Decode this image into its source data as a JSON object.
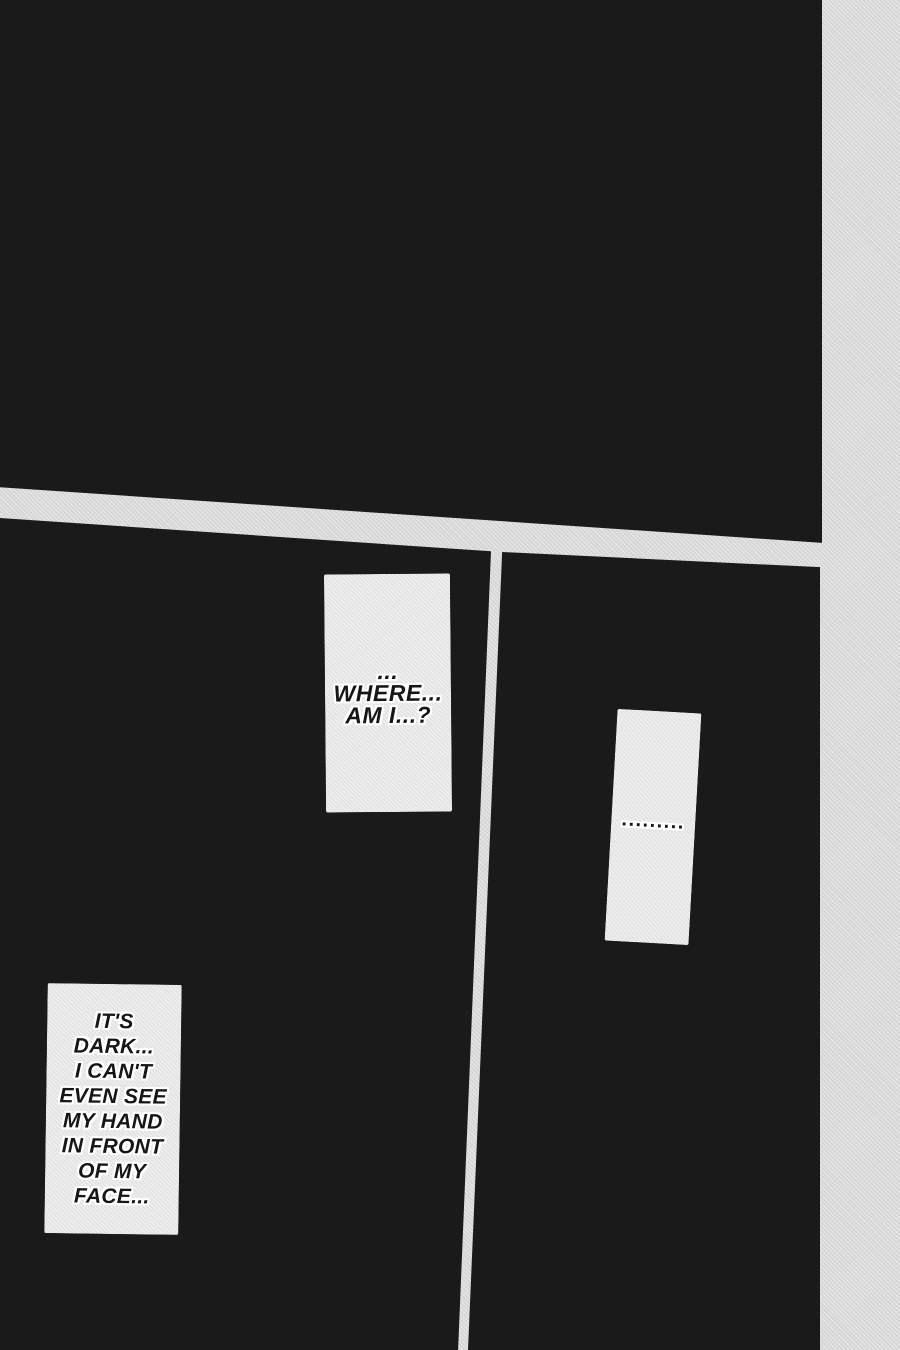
{
  "page": {
    "type": "manga-page",
    "colors": {
      "page_background": "#d8d8d8",
      "panel_black": "#1a1a1a",
      "caption_box": "#e4e4e4",
      "text": "#161616",
      "text_outline": "#ffffff"
    }
  },
  "captions": {
    "where": {
      "lines": [
        "...",
        "WHERE...",
        "AM I...?"
      ]
    },
    "silence": {
      "text": "........."
    },
    "dark": {
      "lines": [
        "IT'S",
        "DARK...",
        "I CAN'T",
        "EVEN SEE",
        "MY HAND",
        "IN FRONT",
        "OF MY",
        "FACE..."
      ]
    }
  }
}
